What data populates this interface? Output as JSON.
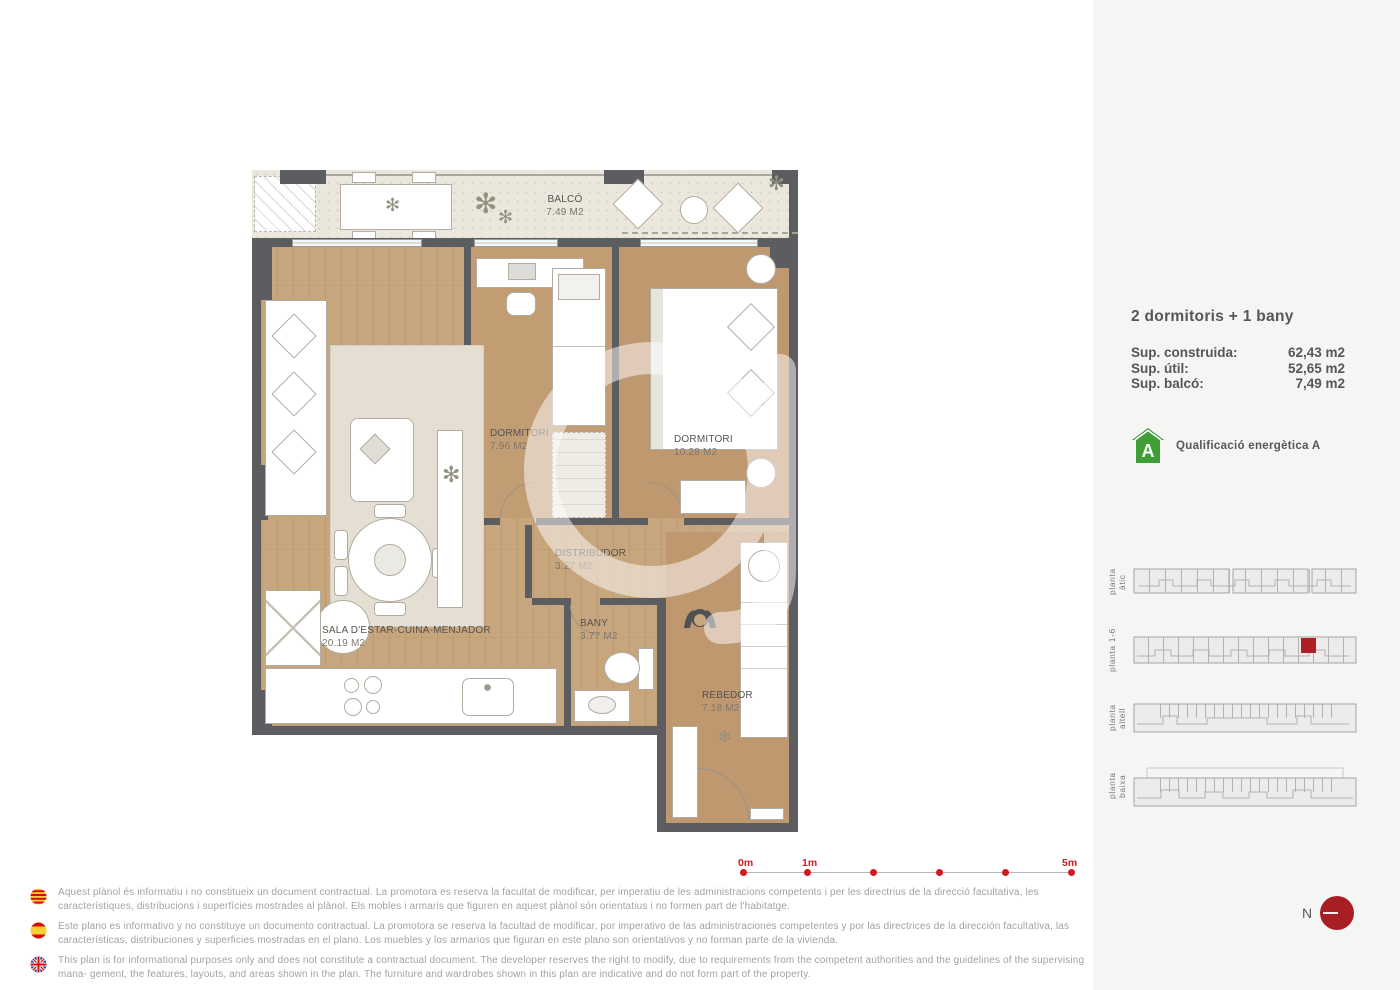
{
  "sidebar": {
    "title": "2 dormitoris + 1 bany",
    "surfaces": [
      {
        "label": "Sup. construida:",
        "value": "62,43 m2"
      },
      {
        "label": "Sup. útil:",
        "value": "52,65 m2"
      },
      {
        "label": "Sup. balcó:",
        "value": "7,49 m2"
      }
    ],
    "energy": {
      "letter": "A",
      "label": "Qualificació energètica A",
      "color": "#3f9e35"
    },
    "floors": [
      {
        "label": "planta  àtic",
        "highlighted": false
      },
      {
        "label": "planta 1-6",
        "highlighted": true
      },
      {
        "label": "planta altell",
        "highlighted": false
      },
      {
        "label": "planta baixa",
        "highlighted": false
      }
    ],
    "highlight_color": "#b01f24"
  },
  "plan": {
    "rooms": [
      {
        "name": "BALCÓ",
        "area": "7.49 M2"
      },
      {
        "name": "DORMITORI",
        "area": "7.96 M2"
      },
      {
        "name": "DORMITORI",
        "area": "10.28 M2"
      },
      {
        "name": "DISTRIBUDOR",
        "area": "3.27 M2"
      },
      {
        "name": "BANY",
        "area": "3.77 M2"
      },
      {
        "name": "SALA D'ESTAR-CUINA-MENJADOR",
        "area": "20.19 M2"
      },
      {
        "name": "REBEDOR",
        "area": "7.18 M2"
      }
    ]
  },
  "scalebar": {
    "labels": [
      "0m",
      "1m",
      "5m"
    ],
    "color": "#cf1b20"
  },
  "north": {
    "label": "N"
  },
  "disclaimers": [
    {
      "flag": "catalonia",
      "text": "Aquest plànol és informatiu i no constitueix un document contractual. La promotora es reserva la facultat de modificar, per imperatiu de les administracions competents i per les directrius de la direcció facultativa, les característiques, distribucions i superfícies mostrades al plànol. Els mobles i armaris que figuren en aquest plànol són orientatius i no formen part de l'habitatge."
    },
    {
      "flag": "spain",
      "text": "Este plano es informativo y no constituye un documento contractual. La promotora se reserva la facultad de modificar, por imperativo de las administraciones competentes y por las directrices de la dirección facultativa, las características, distribuciones y superficies mostradas en el plano. Los muebles y los armarios que figuran en este plano son orientativos y no forman parte de la vivienda."
    },
    {
      "flag": "uk",
      "text": "This plan is for informational purposes only and does not constitute a contractual document. The developer reserves the right to modify, due to requirements from the competent authorities and the guidelines of the supervising mana- gement, the features, layouts, and areas shown in the plan. The furniture and wardrobes shown in this plan are indicative and do not form part of the property."
    }
  ]
}
